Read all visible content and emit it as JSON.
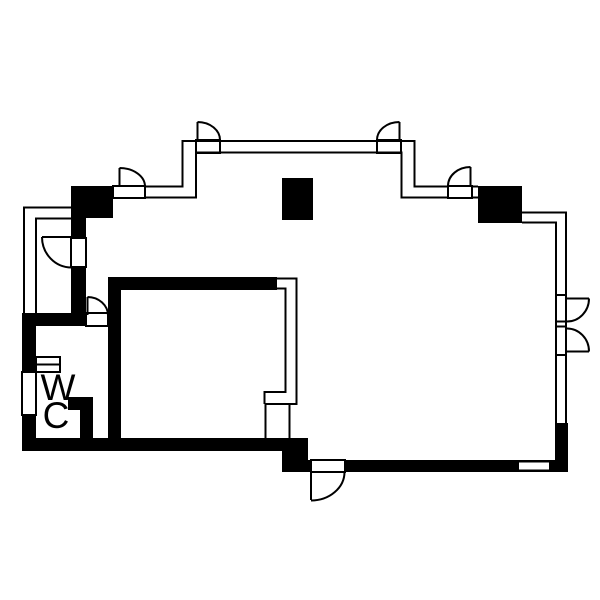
{
  "plan": {
    "colors": {
      "line": "#000000",
      "wall": "#000000",
      "background": "#ffffff"
    },
    "wc_label": {
      "line1": "W",
      "line2": "C"
    }
  }
}
